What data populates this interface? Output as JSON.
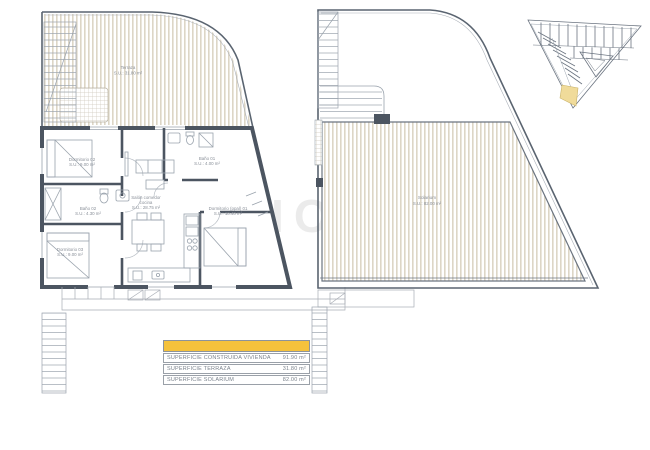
{
  "watermark": {
    "text": "HOMES"
  },
  "left_plan": {
    "rooms": {
      "terraza": {
        "name": "Terraza",
        "area": "S.U.: 31.80 m²"
      },
      "dormitorio_02": {
        "name": "Dormitorio 02",
        "area": "S.U.: 9.00 m²"
      },
      "bano_02": {
        "name": "Baño 02",
        "area": "S.U.: 4.30 m²"
      },
      "dormitorio_03": {
        "name": "Dormitorio 03",
        "area": "S.U.: 9.00 m²"
      },
      "salon_line1": "Salón comedor",
      "salon_line2": "cocina",
      "salon_area": "S.U.: 28.75 m²",
      "bano_01": {
        "name": "Baño 01",
        "area": "S.U.: 4.00 m²"
      },
      "dormitorio_01": {
        "name": "Dormitorio (ppal) 01",
        "area": "S.U.: 10.40 m²"
      }
    }
  },
  "right_plan": {
    "rooms": {
      "solarium": {
        "name": "Solarium",
        "area": "S.U.: 82.00 m²"
      }
    }
  },
  "site_plan": {
    "highlight_color": "#f0db9a"
  },
  "summary_table": {
    "header": "",
    "header_color": "#f5c23c",
    "rows": [
      {
        "label": "SUPERFICIE CONSTRUIDA VIVIENDA",
        "value": "91.90 m²"
      },
      {
        "label": "SUPERFICIE TERRAZA",
        "value": "31.80 m²"
      },
      {
        "label": "SUPERFICIE SOLARIUM",
        "value": "82.00 m²"
      }
    ]
  },
  "colors": {
    "wall": "#4c5561",
    "thin_line": "#9aa3ad",
    "hatch_stripe": "#ddd6c6",
    "label_text": "#8a9099"
  }
}
